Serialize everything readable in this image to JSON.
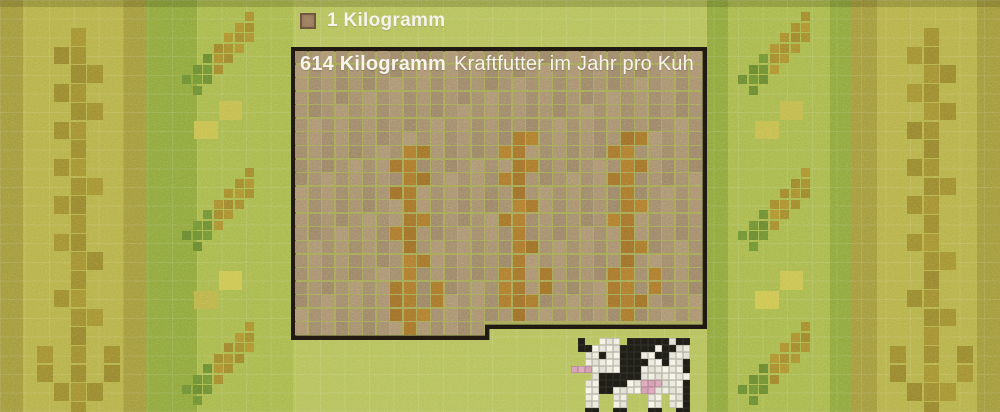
{
  "figure": {
    "legend": {
      "label": "1 Kilogramm"
    },
    "title": {
      "amount": "614 Kilogramm",
      "rest": "Kraftfutter im Jahr pro Kuh"
    }
  },
  "chart_data": {
    "type": "unit_pictogram",
    "title": "614 Kilogramm Kraftfutter im Jahr pro Kuh",
    "legend_unit": {
      "label": "1 Kilogramm",
      "value_kg": 1
    },
    "total_value_kg": 614,
    "unit_grid": {
      "columns": 30,
      "full_rows": 20,
      "partial_row_units": 14
    },
    "motifs": [
      "wheat-stalk-pixel-art",
      "grain-sprig-pixel-art",
      "cow-pixel-art"
    ]
  },
  "palette": {
    "olive_edge": "#a2983f",
    "yellow_stripe": "#b5b04b",
    "olive": "#a39940",
    "green_med": "#8ea63f",
    "side_light": "#a7b84e",
    "center_light": "#b4c05c",
    "motif_olive": "#9c8b33",
    "sprig_gold": "#a58b31",
    "sprig_green": "#6d8d35",
    "yellow_pair": "#c3bc4f",
    "box_border": "#1e1811",
    "box_gridline": "#a5a557",
    "box_cell": "#a28b6b",
    "wheat_orange": "#a6752e",
    "text_white": "#f5f2ea",
    "cow_white": "#eceade",
    "cow_black": "#1d1c15",
    "cow_pink": "#d7a0b5"
  },
  "background": {
    "stripes": [
      {
        "x": 0,
        "w": 23,
        "color": "olive_edge"
      },
      {
        "x": 23,
        "w": 100,
        "color": "yellow_stripe"
      },
      {
        "x": 123,
        "w": 22,
        "color": "olive"
      },
      {
        "x": 145,
        "w": 52,
        "color": "green_med"
      },
      {
        "x": 197,
        "w": 96,
        "color": "side_light"
      },
      {
        "x": 293,
        "w": 414,
        "color": "center_light"
      },
      {
        "x": 707,
        "w": 21,
        "color": "green_med"
      },
      {
        "x": 728,
        "w": 102,
        "color": "side_light"
      },
      {
        "x": 830,
        "w": 22,
        "color": "green_med"
      },
      {
        "x": 852,
        "w": 25,
        "color": "olive"
      },
      {
        "x": 877,
        "w": 100,
        "color": "yellow_stripe"
      },
      {
        "x": 977,
        "w": 23,
        "color": "olive_edge"
      }
    ]
  },
  "box": {
    "x": 291,
    "y": 47,
    "w": 416,
    "h_left": 293,
    "h_right": 282,
    "step_x": 194,
    "cols": 30,
    "rows": 21,
    "last_row_cols": 14,
    "inset": 4
  },
  "decor": {
    "patterns": {
      "bg_stalk": [
        "..X..",
        ".XX..",
        "..XX.",
        ".XX..",
        "..XX.",
        ".XX..",
        "..X..",
        ".XX..",
        "..XX.",
        ".XX..",
        "..X..",
        ".XX..",
        "..XX.",
        "..X..",
        ".XX..",
        "..XX.",
        "..X..",
        "X.X.X",
        "X.X.X",
        ".XXX.",
        "..X.."
      ],
      "box_stalk": [
        "..XX..",
        ".XX...",
        "..XX..",
        ".XX...",
        "..X...",
        "..XX..",
        ".XX...",
        "..X...",
        "..XX..",
        "..X...",
        ".XX.X.",
        ".XX.X.",
        ".XXX..",
        "..X..."
      ],
      "sprig": [
        "......g.",
        ".....gg.",
        "....ggg.",
        "...ggg..",
        "..Ggg...",
        ".GGg....",
        "GGG.....",
        ".G......"
      ],
      "yellow_pair": [
        ".X",
        "X."
      ]
    },
    "bg_stalks": [
      {
        "x": 37,
        "y": 28
      },
      {
        "x": 890,
        "y": 28
      }
    ],
    "bg_stalk_cell": {
      "w": 16.8,
      "h": 18.7
    },
    "box_stalks": [
      {
        "col": 6,
        "row": 7
      },
      {
        "col": 14,
        "row": 6
      },
      {
        "col": 22,
        "row": 6
      }
    ],
    "sprigs": [
      {
        "x": 182,
        "y": 12
      },
      {
        "x": 182,
        "y": 168
      },
      {
        "x": 182,
        "y": 322
      },
      {
        "x": 738,
        "y": 12
      },
      {
        "x": 738,
        "y": 168
      },
      {
        "x": 738,
        "y": 322
      }
    ],
    "sprig_cell": 10.5,
    "pairs": [
      {
        "x": 194,
        "y": 101
      },
      {
        "x": 194,
        "y": 271
      },
      {
        "x": 755,
        "y": 101
      },
      {
        "x": 755,
        "y": 271
      }
    ],
    "pair_cell": {
      "w": 24.5,
      "h": 19.5
    }
  },
  "cow": {
    "x": 571,
    "y": 338,
    "cell": 7,
    "map": [
      ".B..WWW.BBBBBBWBB",
      ".BBWWWWBBBBBWBBWW",
      "..WWBWWBBBWWBBWWW",
      "..WWWWWBBBBWWBWWB",
      "PPPWWWWBBBWWWWWWB",
      "...WBBBBBBWWWWWWW",
      "..WWBBBBWWPPPWWWB",
      "..WWBBWWWWPPWWWWB",
      "..WW..WW...WW.WWB",
      "..WW..WW...WW.WWB",
      "..BB..BB...BB..BB"
    ]
  }
}
